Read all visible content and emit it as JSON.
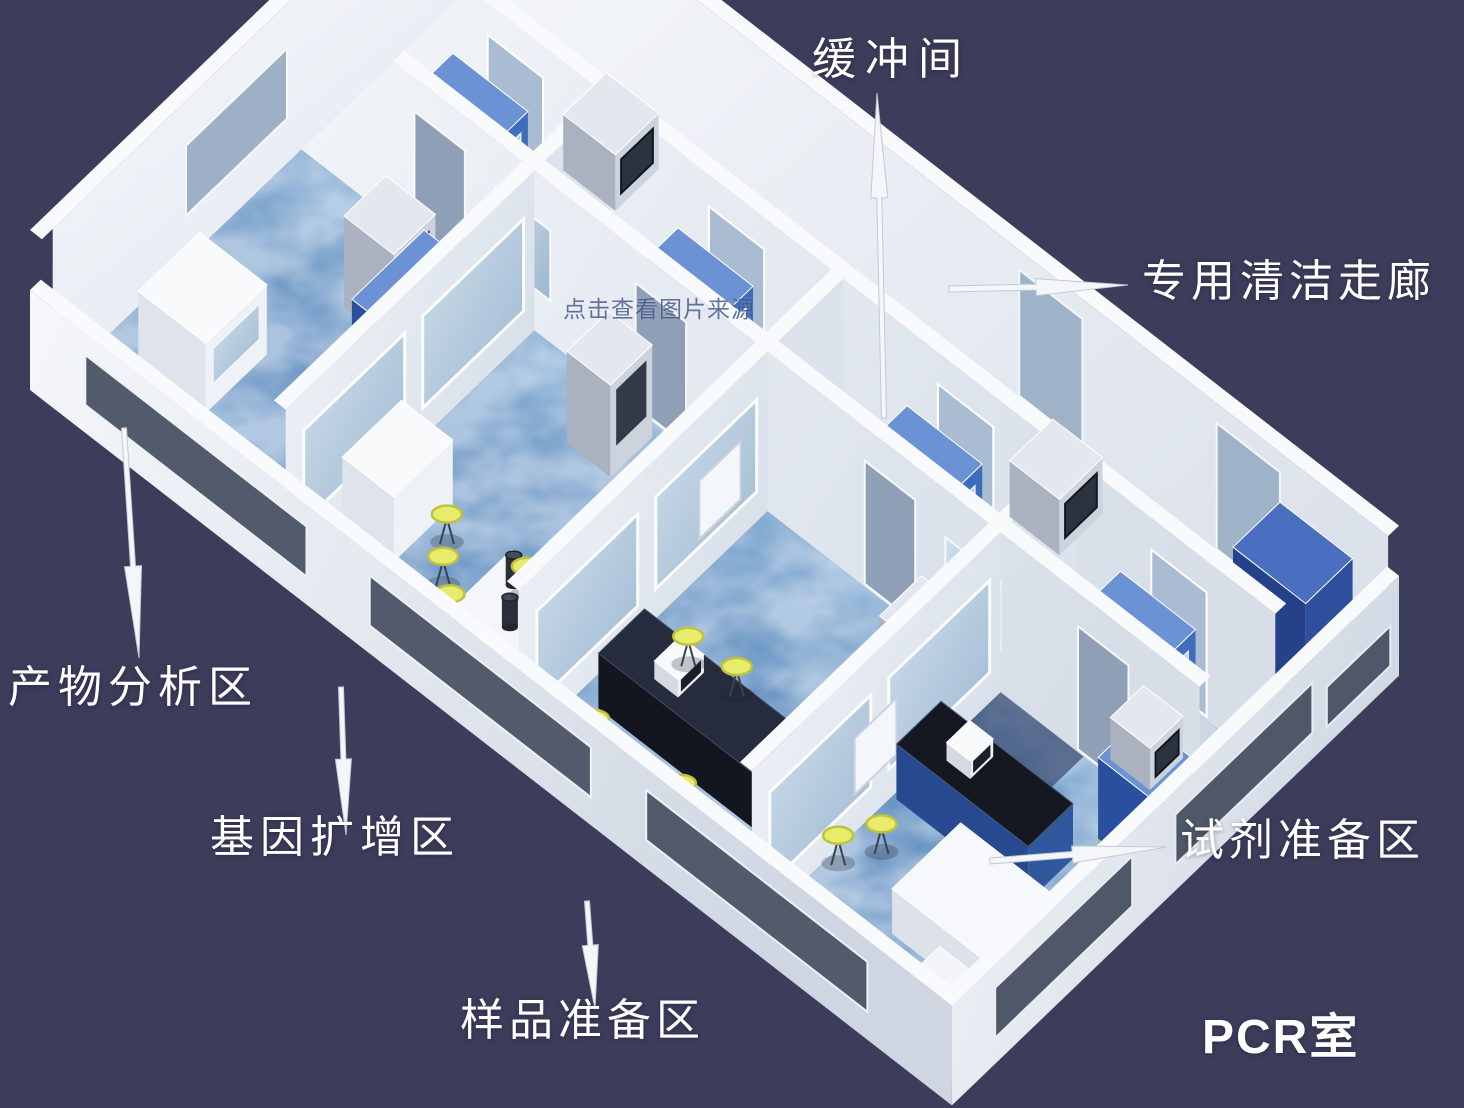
{
  "labels": {
    "buffer_room": "缓冲间",
    "clean_corridor": "专用清洁走廊",
    "product_analysis": "产物分析区",
    "gene_amplification": "基因扩增区",
    "sample_prep": "样品准备区",
    "reagent_prep": "试剂准备区",
    "pcr_room": "PCR室",
    "watermark": "点击查看图片来源"
  },
  "rooms": [
    {
      "id": "product-analysis",
      "label": "产物分析区"
    },
    {
      "id": "gene-amplification",
      "label": "基因扩增区"
    },
    {
      "id": "sample-preparation",
      "label": "样品准备区"
    },
    {
      "id": "reagent-preparation",
      "label": "试剂准备区"
    },
    {
      "id": "buffer-room",
      "label": "缓冲间"
    },
    {
      "id": "clean-corridor",
      "label": "专用清洁走廊"
    }
  ],
  "palette": {
    "background": "#3c3c5b",
    "wall_bright": "#f8fafc",
    "wall_light": "#edf1f6",
    "wall_mid": "#dde3ec",
    "wall_shadow": "#c3cbd9",
    "floor_light": "#a3c2de",
    "floor_mid": "#6f9cc9",
    "floor_deep": "#52799c",
    "corridor_floor": "#dde4ee",
    "buffer_floor": "#ccd7e4",
    "cabinet_blue": "#3f6cbc",
    "cabinet_blue_dark": "#2a4f9e",
    "cabinet_blue_top": "#6b92d4",
    "glass": "#b9cfe2",
    "window_dark": "#515b6b",
    "bench_dark": "#161821",
    "steel": "#ccd2db",
    "stool_yellow": "#e9ec6b",
    "green_trim": "#a8c83e",
    "label_text": "#ffffff",
    "watermark_text": "#44568a"
  },
  "arrows": [
    {
      "name": "buffer-room-arrow",
      "from": [
        884,
        418
      ],
      "to": [
        877,
        93
      ],
      "head": 105,
      "head_w": 17,
      "shaft": 5
    },
    {
      "name": "clean-corridor-arrow",
      "from": [
        949,
        289
      ],
      "to": [
        1128,
        285
      ],
      "head": 92,
      "head_w": 17,
      "shaft": 6
    },
    {
      "name": "product-analysis-arrow",
      "from": [
        124,
        428
      ],
      "to": [
        139,
        658
      ],
      "head": 92,
      "head_w": 17,
      "shaft": 5
    },
    {
      "name": "gene-amplification-arrow",
      "from": [
        341,
        687
      ],
      "to": [
        346,
        835
      ],
      "head": 76,
      "head_w": 16,
      "shaft": 5
    },
    {
      "name": "sample-preparation-arrow",
      "from": [
        587,
        901
      ],
      "to": [
        595,
        1009
      ],
      "head": 64,
      "head_w": 16,
      "shaft": 5
    },
    {
      "name": "reagent-preparation-arrow",
      "from": [
        990,
        861
      ],
      "to": [
        1167,
        847
      ],
      "head": 95,
      "head_w": 17,
      "shaft": 6
    }
  ]
}
